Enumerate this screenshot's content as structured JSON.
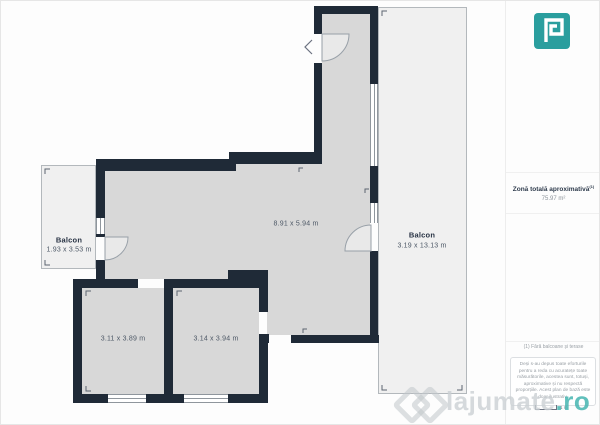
{
  "plan": {
    "colors": {
      "wall": "#1f2a37",
      "room_fill": "#d8d8d8",
      "balcony_fill": "#f0f0f0"
    },
    "rooms": [
      {
        "name": "living",
        "dimensions": "8.91 x 5.94 m"
      },
      {
        "name": "room-1",
        "dimensions": "3.11 x 3.89 m"
      },
      {
        "name": "room-2",
        "dimensions": "3.14 x 3.94 m"
      }
    ],
    "balconies": [
      {
        "name": "balcony-left",
        "label": "Balcon",
        "dimensions": "1.93 x 3.53 m"
      },
      {
        "name": "balcony-right",
        "label": "Balcon",
        "dimensions": "3.19 x 13.13 m"
      }
    ]
  },
  "side_panel": {
    "logo_color": "#2a9e9e",
    "total_area": {
      "label": "Zonă totală aproximativă",
      "superscript": "(1)",
      "value": "75.97 m²"
    },
    "footnote": "(1) Fără balcoane și terase",
    "disclaimer": "Deși s-au depus toate eforturile pentru a reda cu acuratețe toate măsurătorile, acestea sunt, totuși, aproximative și nu respectă proporțiile. Acest plan de bază este doar ilustrativ.",
    "scale_label": "1 m"
  },
  "watermark": {
    "text": "lajumate",
    "suffix": ".ro",
    "accent_color": "#45b5b0"
  }
}
